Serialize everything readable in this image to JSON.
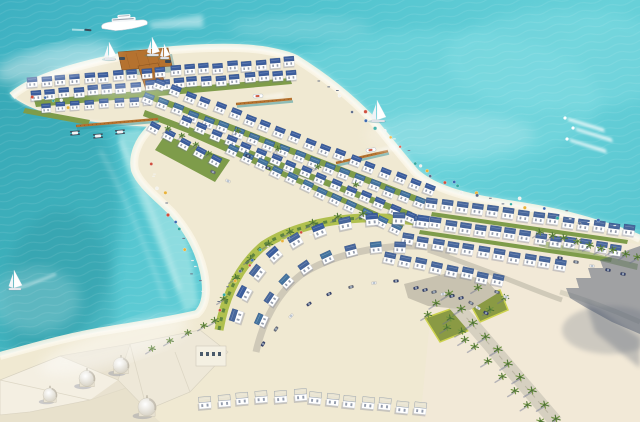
{
  "scene": {
    "title": "Aerial architectural rendering of a beachfront resort island with white blue-roofed villas, turquoise sea, marina piers, palm-lined roads and a domed palace",
    "objects": [
      "sea",
      "island",
      "beach",
      "villas",
      "crescent-villas",
      "palace",
      "domes",
      "palm-trees",
      "yacht",
      "sailboats",
      "catamarans",
      "jetski-wakes",
      "piers",
      "boardwalk",
      "plaza",
      "entry-road",
      "cars",
      "beach-umbrellas",
      "building-shadow",
      "haze"
    ],
    "colors": {
      "water_top": "#41b6c6",
      "water_mid": "#57c7d1",
      "water_light": "#78d8de",
      "water_deep": "#2f9fab",
      "lagoon": "#a9e7e7",
      "foam": "#ffffff",
      "sand": "#f0e9d2",
      "sand_bright": "#faf5e6",
      "green": "#7e9c4a",
      "green_bright": "#b0c04e",
      "green_dark": "#5e8440",
      "roof_blue": "#3c5e9e",
      "roof_teal": "#44749e",
      "roof_slate": "#48679c",
      "roof_white": "#e9e4d2",
      "roof_edge": "#2c4a80",
      "wall": "#ffffff",
      "pier": "#b5722f",
      "pier_dark": "#8a5420",
      "road": "#cfc9b8",
      "plaza": "#c8c2b0",
      "car_navy": "#3a4670",
      "car_gray": "#6a7080",
      "car_white": "#e8e8e8",
      "palm": "#6f9440",
      "palm_dark": "#4e7434",
      "trunk": "#8a6a42",
      "shadow": "#6a7290",
      "highrise_shadow": "#4e5a70",
      "dome_edge": "#c8c2b0",
      "hull_dark": "#3a4a58"
    },
    "villa_rows": [
      {
        "x1": 32,
        "y1": 82,
        "x2": 290,
        "y2": 62,
        "n": 19,
        "s": 10,
        "roof": "blue"
      },
      {
        "x1": 36,
        "y1": 95,
        "x2": 292,
        "y2": 74,
        "n": 19,
        "s": 10,
        "roof": "blue"
      },
      {
        "x1": 46,
        "y1": 107,
        "x2": 148,
        "y2": 100,
        "n": 8,
        "s": 9,
        "roof": "blue"
      },
      {
        "x1": 160,
        "y1": 85,
        "x2": 430,
        "y2": 190,
        "n": 19,
        "s": 10,
        "roof": "blue"
      },
      {
        "x1": 148,
        "y1": 98,
        "x2": 420,
        "y2": 203,
        "n": 19,
        "s": 10,
        "roof": "teal"
      },
      {
        "x1": 186,
        "y1": 122,
        "x2": 410,
        "y2": 216,
        "n": 16,
        "s": 10,
        "roof": "blue"
      },
      {
        "x1": 232,
        "y1": 150,
        "x2": 396,
        "y2": 228,
        "n": 12,
        "s": 10,
        "roof": "teal"
      },
      {
        "x1": 155,
        "y1": 128,
        "x2": 215,
        "y2": 160,
        "n": 5,
        "s": 10,
        "roof": "blue"
      },
      {
        "x1": 432,
        "y1": 203,
        "x2": 630,
        "y2": 230,
        "n": 14,
        "s": 11,
        "roof": "slate"
      },
      {
        "x1": 420,
        "y1": 221,
        "x2": 616,
        "y2": 249,
        "n": 14,
        "s": 11,
        "roof": "slate"
      },
      {
        "x1": 407,
        "y1": 239,
        "x2": 560,
        "y2": 264,
        "n": 11,
        "s": 11,
        "roof": "slate"
      },
      {
        "x1": 390,
        "y1": 257,
        "x2": 498,
        "y2": 280,
        "n": 8,
        "s": 11,
        "roof": "slate"
      },
      {
        "x1": 315,
        "y1": 397,
        "x2": 420,
        "y2": 408,
        "n": 7,
        "s": 12,
        "roof": "white"
      },
      {
        "x1": 205,
        "y1": 402,
        "x2": 300,
        "y2": 394,
        "n": 6,
        "s": 12,
        "roof": "white"
      }
    ],
    "villa_list": [
      {
        "x": 236,
        "y": 316,
        "r": -72,
        "s": 12,
        "roof": "slate"
      },
      {
        "x": 244,
        "y": 293,
        "r": -62,
        "s": 12,
        "roof": "blue"
      },
      {
        "x": 257,
        "y": 272,
        "r": -52,
        "s": 12,
        "roof": "slate"
      },
      {
        "x": 274,
        "y": 254,
        "r": -42,
        "s": 12,
        "roof": "blue"
      },
      {
        "x": 295,
        "y": 240,
        "r": -31,
        "s": 12,
        "roof": "slate"
      },
      {
        "x": 319,
        "y": 230,
        "r": -21,
        "s": 12,
        "roof": "blue"
      },
      {
        "x": 345,
        "y": 223,
        "r": -12,
        "s": 12,
        "roof": "slate"
      },
      {
        "x": 372,
        "y": 219,
        "r": -5,
        "s": 12,
        "roof": "blue"
      },
      {
        "x": 399,
        "y": 218,
        "r": 2,
        "s": 12,
        "roof": "slate"
      },
      {
        "x": 423,
        "y": 221,
        "r": 8,
        "s": 12,
        "roof": "blue"
      },
      {
        "x": 261,
        "y": 320,
        "r": -66,
        "s": 11,
        "roof": "teal"
      },
      {
        "x": 271,
        "y": 299,
        "r": -56,
        "s": 11,
        "roof": "slate"
      },
      {
        "x": 286,
        "y": 281,
        "r": -46,
        "s": 11,
        "roof": "teal"
      },
      {
        "x": 305,
        "y": 267,
        "r": -35,
        "s": 11,
        "roof": "slate"
      },
      {
        "x": 327,
        "y": 257,
        "r": -25,
        "s": 11,
        "roof": "teal"
      },
      {
        "x": 351,
        "y": 250,
        "r": -15,
        "s": 11,
        "roof": "slate"
      },
      {
        "x": 376,
        "y": 247,
        "r": -6,
        "s": 11,
        "roof": "teal"
      },
      {
        "x": 400,
        "y": 247,
        "r": 2,
        "s": 11,
        "roof": "slate"
      }
    ],
    "palm_rows": [
      {
        "x1": 450,
        "y1": 296,
        "x2": 556,
        "y2": 420,
        "n": 10,
        "s": 9
      },
      {
        "x1": 437,
        "y1": 304,
        "x2": 540,
        "y2": 422,
        "n": 9,
        "s": 8
      },
      {
        "x1": 540,
        "y1": 234,
        "x2": 638,
        "y2": 258,
        "n": 9,
        "s": 8
      }
    ],
    "palm_list": [
      {
        "x": 215,
        "y": 322,
        "s": 8
      },
      {
        "x": 224,
        "y": 300,
        "s": 8
      },
      {
        "x": 236,
        "y": 279,
        "s": 8
      },
      {
        "x": 251,
        "y": 260,
        "s": 8
      },
      {
        "x": 269,
        "y": 245,
        "s": 8
      },
      {
        "x": 290,
        "y": 233,
        "s": 8
      },
      {
        "x": 313,
        "y": 224,
        "s": 8
      },
      {
        "x": 338,
        "y": 218,
        "s": 8
      },
      {
        "x": 363,
        "y": 215,
        "s": 8
      },
      {
        "x": 152,
        "y": 350,
        "s": 7
      },
      {
        "x": 170,
        "y": 342,
        "s": 7
      },
      {
        "x": 188,
        "y": 334,
        "s": 7
      },
      {
        "x": 204,
        "y": 327,
        "s": 7
      },
      {
        "x": 428,
        "y": 316,
        "s": 8
      },
      {
        "x": 447,
        "y": 329,
        "s": 8
      },
      {
        "x": 465,
        "y": 341,
        "s": 8
      },
      {
        "x": 490,
        "y": 311,
        "s": 8
      },
      {
        "x": 505,
        "y": 299,
        "s": 8
      },
      {
        "x": 478,
        "y": 289,
        "s": 8
      },
      {
        "x": 168,
        "y": 130,
        "s": 6
      },
      {
        "x": 182,
        "y": 137,
        "s": 6
      },
      {
        "x": 196,
        "y": 146,
        "s": 6
      },
      {
        "x": 209,
        "y": 155,
        "s": 6
      },
      {
        "x": 238,
        "y": 132,
        "s": 6
      },
      {
        "x": 278,
        "y": 150,
        "s": 6
      },
      {
        "x": 318,
        "y": 168,
        "s": 6
      },
      {
        "x": 356,
        "y": 186,
        "s": 6
      }
    ],
    "car_list": [
      {
        "x": 416,
        "y": 288,
        "r": -15
      },
      {
        "x": 425,
        "y": 290,
        "r": -15
      },
      {
        "x": 434,
        "y": 292,
        "r": -15
      },
      {
        "x": 443,
        "y": 294,
        "r": -15
      },
      {
        "x": 452,
        "y": 296,
        "r": -15
      },
      {
        "x": 461,
        "y": 298,
        "r": -15
      },
      {
        "x": 471,
        "y": 303,
        "r": 30
      },
      {
        "x": 478,
        "y": 308,
        "r": 30
      },
      {
        "x": 486,
        "y": 313,
        "r": 30
      },
      {
        "x": 263,
        "y": 344,
        "r": -60
      },
      {
        "x": 276,
        "y": 329,
        "r": -55
      },
      {
        "x": 291,
        "y": 316,
        "r": -45
      },
      {
        "x": 309,
        "y": 304,
        "r": -35
      },
      {
        "x": 329,
        "y": 294,
        "r": -25
      },
      {
        "x": 351,
        "y": 287,
        "r": -15
      },
      {
        "x": 374,
        "y": 283,
        "r": -8
      },
      {
        "x": 396,
        "y": 281,
        "r": -3
      },
      {
        "x": 560,
        "y": 258,
        "r": 10
      },
      {
        "x": 576,
        "y": 262,
        "r": 10
      },
      {
        "x": 592,
        "y": 266,
        "r": 10
      },
      {
        "x": 608,
        "y": 270,
        "r": 10
      },
      {
        "x": 623,
        "y": 274,
        "r": 10
      },
      {
        "x": 213,
        "y": 172,
        "r": 25
      },
      {
        "x": 228,
        "y": 181,
        "r": 25
      },
      {
        "x": 248,
        "y": 156,
        "r": 22
      },
      {
        "x": 268,
        "y": 168,
        "r": 22
      },
      {
        "x": 497,
        "y": 292,
        "r": 20
      },
      {
        "x": 506,
        "y": 297,
        "r": 20
      }
    ],
    "umbrella_strips": [
      {
        "pts": [
          [
            318,
            82
          ],
          [
            370,
            122
          ],
          [
            420,
            166
          ],
          [
            468,
            192
          ],
          [
            540,
            209
          ],
          [
            618,
            230
          ]
        ],
        "n": 40,
        "off": 5
      },
      {
        "pts": [
          [
            148,
            158
          ],
          [
            172,
            215
          ],
          [
            192,
            266
          ],
          [
            200,
            298
          ]
        ],
        "n": 16,
        "off": 4
      },
      {
        "pts": [
          [
            214,
            316
          ],
          [
            238,
            272
          ],
          [
            272,
            247
          ],
          [
            312,
            230
          ]
        ],
        "n": 14,
        "off": 4
      },
      {
        "pts": [
          [
            30,
            95
          ],
          [
            80,
            108
          ]
        ],
        "n": 6,
        "off": 3
      }
    ],
    "umbrella_palette": [
      "#cf4f3e",
      "#3a68b0",
      "#2fa8a0",
      "#f2f2ee",
      "#e8b23a",
      "#5a6a88"
    ],
    "boat_list": [
      {
        "type": "yacht",
        "x": 125,
        "y": 24,
        "r": -4
      },
      {
        "type": "sail",
        "x": 109,
        "y": 58,
        "r": 0,
        "h": 16
      },
      {
        "type": "sail",
        "x": 152,
        "y": 54,
        "r": 0,
        "h": 17
      },
      {
        "type": "sail",
        "x": 164,
        "y": 57,
        "r": 0,
        "h": 13
      },
      {
        "type": "sail",
        "x": 377,
        "y": 120,
        "r": 0,
        "h": 20
      },
      {
        "type": "sail",
        "x": 14,
        "y": 288,
        "r": 0,
        "h": 18,
        "wake": 42
      },
      {
        "type": "motor",
        "x": 371,
        "y": 150,
        "r": -8
      },
      {
        "type": "motor",
        "x": 258,
        "y": 96,
        "r": -4
      },
      {
        "type": "cat",
        "x": 75,
        "y": 133,
        "r": -5
      },
      {
        "type": "cat",
        "x": 98,
        "y": 136,
        "r": -5
      },
      {
        "type": "cat",
        "x": 120,
        "y": 132,
        "r": -5
      },
      {
        "type": "jet",
        "x": 565,
        "y": 118,
        "r": 12
      },
      {
        "type": "jet",
        "x": 573,
        "y": 128,
        "r": 12
      },
      {
        "type": "jet",
        "x": 567,
        "y": 139,
        "r": 12
      },
      {
        "type": "small",
        "x": 88,
        "y": 30,
        "r": 5
      }
    ],
    "piers": [
      {
        "x1": 76,
        "y1": 126,
        "x2": 158,
        "y2": 119
      },
      {
        "x1": 336,
        "y1": 163,
        "x2": 388,
        "y2": 151
      },
      {
        "x1": 236,
        "y1": 104,
        "x2": 292,
        "y2": 99
      }
    ],
    "domes": [
      {
        "x": 50,
        "y": 398,
        "r": 7
      },
      {
        "x": 87,
        "y": 382,
        "r": 8
      },
      {
        "x": 121,
        "y": 369,
        "r": 8
      },
      {
        "x": 147,
        "y": 411,
        "r": 9
      }
    ]
  }
}
